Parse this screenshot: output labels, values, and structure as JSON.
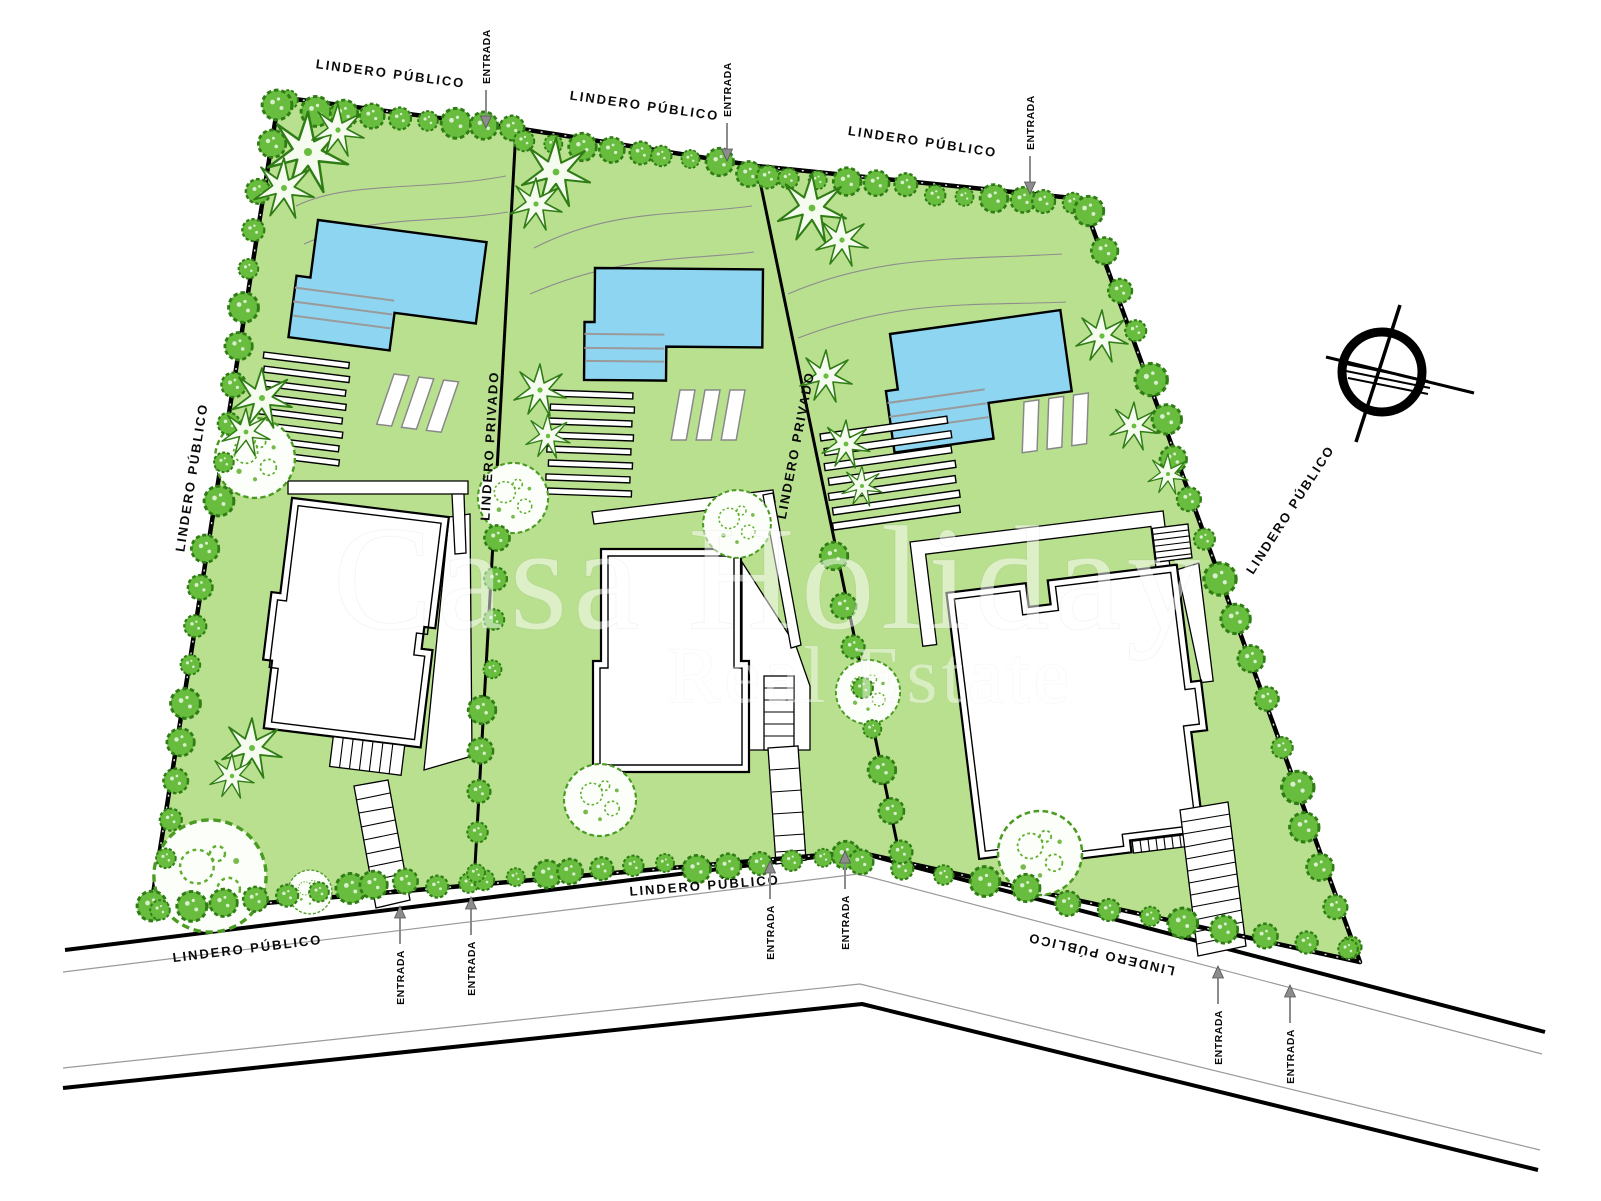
{
  "document": {
    "kind": "residential site plan",
    "watermark": {
      "line1": "Casa Holiday",
      "line2": "Real Estate"
    }
  },
  "labels": {
    "public_boundary": "LINDERO PÚBLICO",
    "private_boundary": "LINDERO PRIVADO",
    "entrance": "ENTRADA"
  },
  "icons": {
    "compass": "north-compass",
    "entrance_arrow": "entrance-arrow"
  },
  "colors": {
    "lawn": "#b9e08f",
    "pool": "#8ed5f1",
    "tree": "#68bd3e",
    "tree_dark": "#2f7d14",
    "tree_big_fill": "#fcfef9",
    "contour": "#8d8d8d",
    "step": "#9a9a9a",
    "arrow": "#8c8c8c",
    "road_thin": "#9a9a9a",
    "outline": "#000000",
    "watermark": "#ffffff"
  },
  "vegetation": {
    "bush_rows": [
      {
        "from": [
          292,
          104
        ],
        "to": [
          508,
          131
        ],
        "n": 9,
        "r": 13
      },
      {
        "from": [
          524,
          138
        ],
        "to": [
          750,
          170
        ],
        "n": 9,
        "r": 12
      },
      {
        "from": [
          764,
          176
        ],
        "to": [
          1076,
          204
        ],
        "n": 12,
        "r": 12
      },
      {
        "from": [
          1090,
          212
        ],
        "to": [
          1352,
          948
        ],
        "n": 19,
        "r": 14
      },
      {
        "from": [
          274,
          108
        ],
        "to": [
          156,
          902
        ],
        "n": 21,
        "r": 13
      },
      {
        "from": [
          162,
          906
        ],
        "to": [
          470,
          880
        ],
        "n": 11,
        "r": 13
      },
      {
        "from": [
          482,
          878
        ],
        "to": [
          850,
          856
        ],
        "n": 13,
        "r": 12
      },
      {
        "from": [
          864,
          862
        ],
        "to": [
          1348,
          952
        ],
        "n": 13,
        "r": 13
      },
      {
        "from": [
          496,
          540
        ],
        "to": [
          476,
          874
        ],
        "n": 9,
        "r": 12
      },
      {
        "from": [
          838,
          560
        ],
        "to": [
          898,
          854
        ],
        "n": 8,
        "r": 12
      }
    ],
    "palms": [
      [
        308,
        152,
        40
      ],
      [
        284,
        188,
        30
      ],
      [
        338,
        130,
        26
      ],
      [
        262,
        398,
        30
      ],
      [
        246,
        432,
        24
      ],
      [
        252,
        748,
        30
      ],
      [
        232,
        776,
        22
      ],
      [
        556,
        172,
        34
      ],
      [
        536,
        204,
        26
      ],
      [
        540,
        390,
        26
      ],
      [
        548,
        436,
        22
      ],
      [
        812,
        208,
        34
      ],
      [
        842,
        240,
        26
      ],
      [
        826,
        376,
        26
      ],
      [
        846,
        444,
        24
      ],
      [
        862,
        486,
        20
      ],
      [
        1102,
        336,
        26
      ],
      [
        1134,
        426,
        24
      ],
      [
        1168,
        474,
        20
      ]
    ],
    "big_trees": [
      [
        255,
        458,
        40
      ],
      [
        210,
        876,
        56
      ],
      [
        310,
        892,
        22
      ],
      [
        513,
        498,
        35
      ],
      [
        737,
        524,
        34
      ],
      [
        600,
        800,
        36
      ],
      [
        868,
        692,
        32
      ],
      [
        1040,
        853,
        42
      ]
    ]
  }
}
